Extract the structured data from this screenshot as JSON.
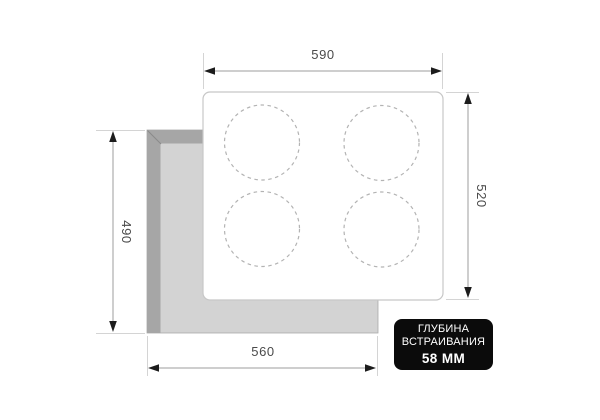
{
  "diagram": {
    "type": "installation-dimensions",
    "subject": "built-in 4-burner hob, top view with countertop cutout",
    "dimensions": {
      "width_top": "590",
      "height_right": "520",
      "cutout_height_left": "490",
      "cutout_width_bottom": "560"
    },
    "badge": {
      "line1": "ГЛУБИНА",
      "line2": "ВСТРАИВАНИЯ",
      "line3": "58 ММ",
      "bg": "#0b0b0b",
      "text_color": "#ffffff"
    },
    "burner_count": 4,
    "colors": {
      "background": "#ffffff",
      "cutout_fill": "#d3d3d3",
      "cutout_rim": "#a6a6a6",
      "cutout_edge": "#ababab",
      "hob_fill": "#ffffff",
      "hob_border": "#c7c7c7",
      "burner_dash": "#b3b3b3",
      "dim_line": "#9c9c9c",
      "extension_line": "#d4d4d4",
      "arrow": "#1c1c1c",
      "dim_text": "#4a4a4a"
    }
  }
}
